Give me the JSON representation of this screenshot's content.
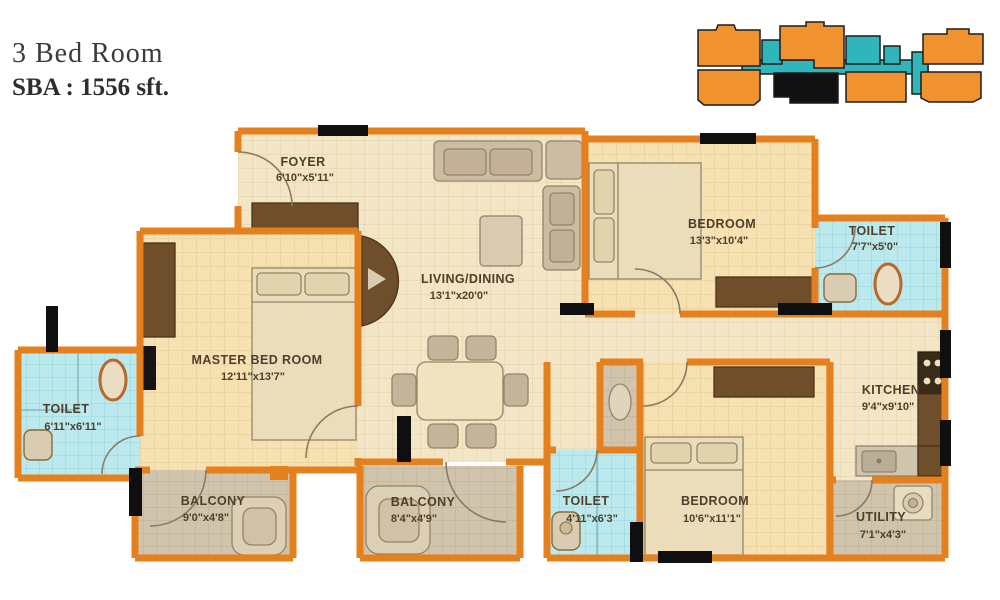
{
  "title": {
    "line1": "3 Bed Room",
    "line2": "SBA : 1556 sft."
  },
  "rooms": [
    {
      "id": "foyer",
      "name": "FOYER",
      "dims": "6'10\"x5'11\""
    },
    {
      "id": "living-dining",
      "name": "LIVING/DINING",
      "dims": "13'1\"x20'0\""
    },
    {
      "id": "bedroom-top",
      "name": "BEDROOM",
      "dims": "13'3\"x10'4\""
    },
    {
      "id": "toilet-top",
      "name": "TOILET",
      "dims": "7'7\"x5'0\""
    },
    {
      "id": "master-bedroom",
      "name": "MASTER BED ROOM",
      "dims": "12'11\"x13'7\""
    },
    {
      "id": "toilet-left",
      "name": "TOILET",
      "dims": "6'11\"x6'11\""
    },
    {
      "id": "balcony-left",
      "name": "BALCONY",
      "dims": "9'0\"x4'8\""
    },
    {
      "id": "balcony-center",
      "name": "BALCONY",
      "dims": "8'4\"x4'9\""
    },
    {
      "id": "toilet-bottom",
      "name": "TOILET",
      "dims": "4'11\"x6'3\""
    },
    {
      "id": "bedroom-bottom",
      "name": "BEDROOM",
      "dims": "10'6\"x11'1\""
    },
    {
      "id": "kitchen",
      "name": "KITCHEN",
      "dims": "9'4\"x9'10\""
    },
    {
      "id": "utility",
      "name": "UTILITY",
      "dims": "7'1\"x4'3\""
    }
  ],
  "key_plan": {
    "units_color": "#F0922E",
    "corridor_color": "#2FB5BA",
    "highlight_color": "#111111"
  },
  "colors": {
    "wall_orange": "#E5801F",
    "floor_cream": "#F3E6C6",
    "floor_bedroom": "#F5E1B2",
    "floor_toilet": "#BCE9ED",
    "floor_balcony": "#D0C4AC",
    "wood_dark": "#6F4E2C",
    "label_text": "#4E3F2C"
  }
}
